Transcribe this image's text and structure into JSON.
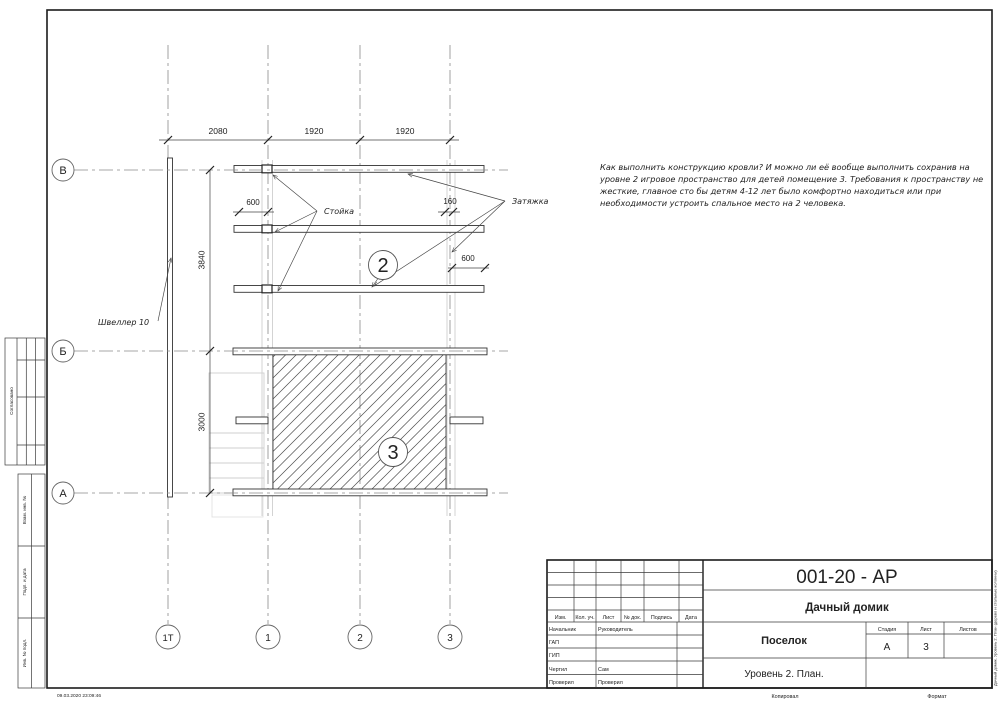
{
  "page": {
    "timestamp": "09.03.2020 23:09:46",
    "copied_label": "Копировал",
    "format_label": "Формат",
    "edge_note": "Дачный домик. Уровень 2. План (дерево и стальные колонны)"
  },
  "annotation": {
    "lines": [
      "Как выполнить конструкцию кровли? И можно ли её вообще выполнить сохранив на",
      "уровне 2 игровое пространство для детей помещение 3. Требования к пространству не",
      "жесткие, главное сто бы детям 4-12 лет было комфортно находиться или при",
      "необходимости устроить спальное место на 2 человека."
    ]
  },
  "plan": {
    "row_axes": [
      "В",
      "Б",
      "А"
    ],
    "col_axes": [
      "1Т",
      "1",
      "2",
      "3"
    ],
    "dim_top": [
      "2080",
      "1920",
      "1920"
    ],
    "dim_left": [
      "3840",
      "3000"
    ],
    "dim_600_left": "600",
    "dim_160": "160",
    "dim_600_right": "600",
    "label_channel": "Швеллер 10",
    "label_post": "Стойка",
    "label_tie": "Затяжка",
    "room2": "2",
    "room3": "3"
  },
  "left_margin": {
    "approved": "Согласовано",
    "vzam": "Взам. инв. №",
    "podp": "Подп. и дата",
    "inv": "Инв. № подл."
  },
  "title_block": {
    "code": "001-20 - АР",
    "project": "Дачный домик",
    "object": "Поселок",
    "sheet_title": "Уровень 2. План.",
    "cols": [
      "Изм.",
      "Кол. уч.",
      "Лист",
      "№ док.",
      "Подпись",
      "Дата"
    ],
    "rows": [
      {
        "role": "Начальник",
        "name": "Руководитель"
      },
      {
        "role": "ГАП",
        "name": ""
      },
      {
        "role": "ГИП",
        "name": ""
      },
      {
        "role": "Чертил",
        "name": "Сам"
      },
      {
        "role": "Проверил",
        "name": "Проверил"
      }
    ],
    "stage_label": "Стадия",
    "list_label": "Лист",
    "lists_label": "Листов",
    "stage": "А",
    "sheet_no": "3"
  }
}
